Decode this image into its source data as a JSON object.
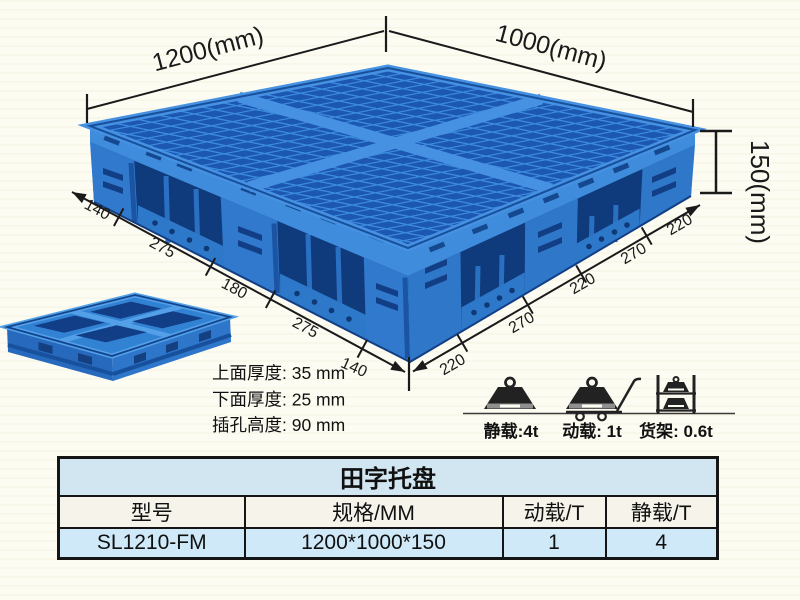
{
  "diagram": {
    "width_label": "1200(mm)",
    "depth_label": "1000(mm)",
    "height_label": "150(mm)",
    "left_chain": [
      "140",
      "275",
      "180",
      "275",
      "140"
    ],
    "right_chain": [
      "220",
      "270",
      "220",
      "270",
      "220"
    ],
    "spec_lines": [
      "上面厚度: 35 mm",
      "下面厚度: 25 mm",
      "插孔高度: 90 mm"
    ]
  },
  "load_ratings": [
    {
      "icon": "static-load-weight-icon",
      "label": "静载:4t"
    },
    {
      "icon": "dynamic-load-trolley-icon",
      "label": "动载: 1t"
    },
    {
      "icon": "rack-load-shelf-icon",
      "label": "货架: 0.6t"
    }
  ],
  "table": {
    "title": "田字托盘",
    "headers": [
      "型号",
      "规格/MM",
      "动载/T",
      "静载/T"
    ],
    "rows": [
      [
        "SL1210-FM",
        "1200*1000*150",
        "1",
        "4"
      ]
    ]
  },
  "colors": {
    "pallet_blue": "#3079cd",
    "pallet_dark_blue": "#1c57b2",
    "pallet_light_blue": "#3f8bdc",
    "pocket_blue": "#0f3a7c",
    "line_color": "#1a1a1a",
    "table_title_bg": "#d2e6f1",
    "table_header_bg": "#f6f3ea",
    "table_row_bg": "#cfe9f8",
    "background": "#fdfcf3"
  }
}
